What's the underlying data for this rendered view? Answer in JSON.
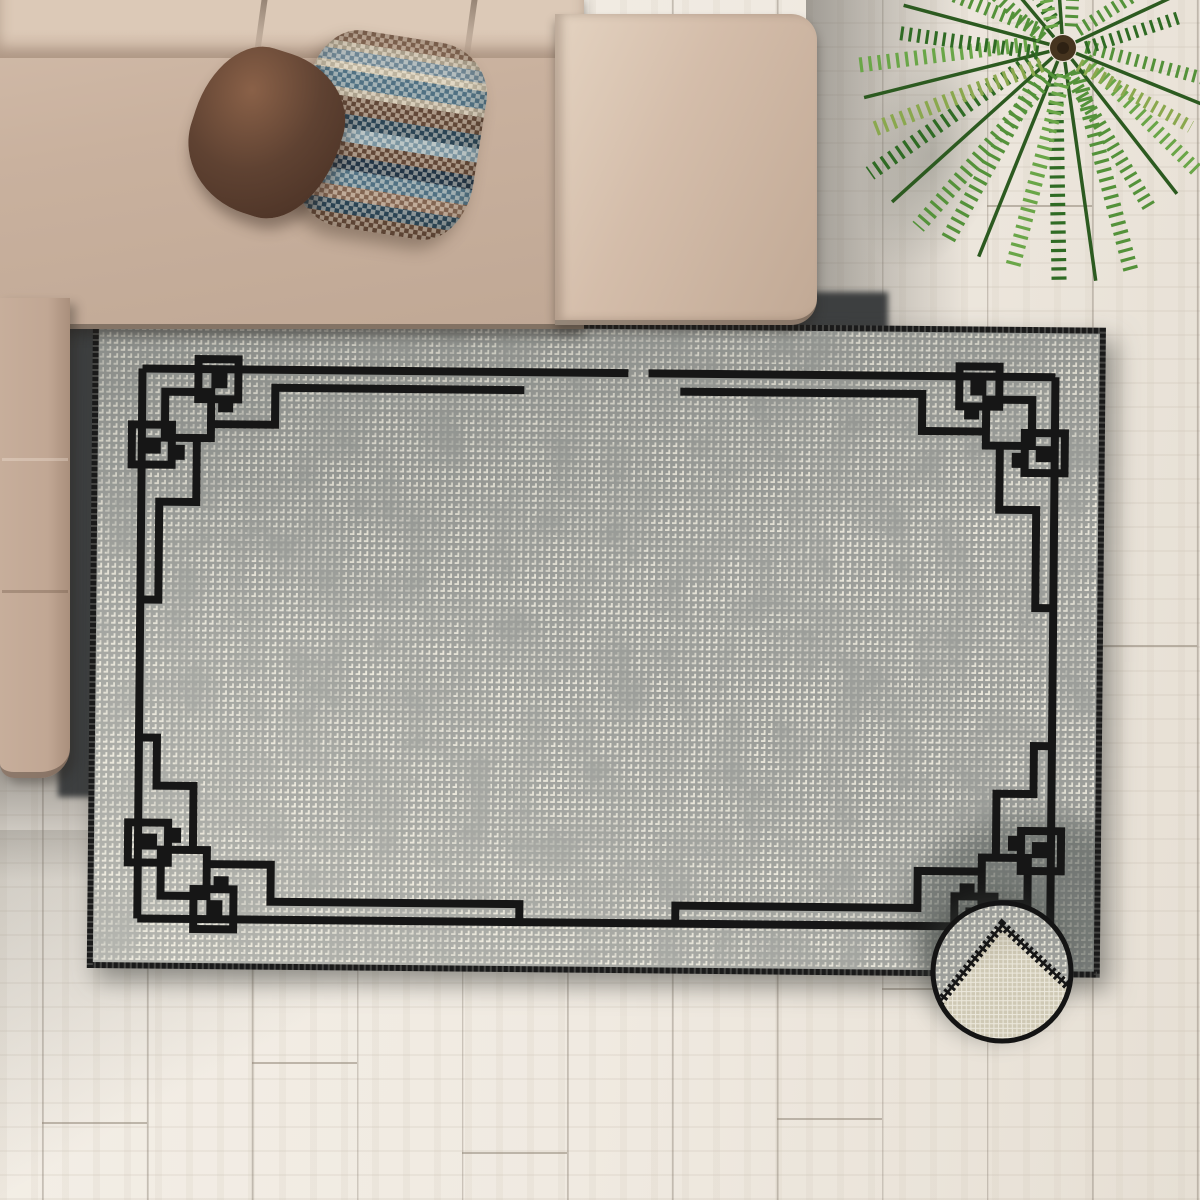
{
  "scene": {
    "type": "product-photo",
    "subject": "gray distressed area rug with black geometric fret border, top-down living-room view",
    "items": [
      "wood-plank-floor",
      "beige-sectional-sofa",
      "brown-velvet-pillow",
      "checkered-stripe-pillow",
      "area-rug",
      "folded-corner-detail-inset",
      "palm-plant"
    ]
  },
  "colors": {
    "floor": "#efe9e0",
    "floorLine": "#8f8274",
    "sofa": "#c9b19e",
    "sofaLight": "#dcc9b7",
    "sofaDark": "#a98f7c",
    "sofaShadow": "#3d3f40",
    "pillowBrown": "#5f4232",
    "pillowBrownLight": "#8a6148",
    "rugGray": "#9c9e9a",
    "rugCream": "#ece9dc",
    "rugLine": "#161616",
    "rugEdge": "#1a1a1a",
    "rugBackCream": "#cfc9b5",
    "insetRing": "#141414",
    "palmDark": "#2f6b24",
    "palmMid": "#54923a",
    "palmLight": "#6aa648",
    "palmYellow": "#8aa84e",
    "palmCenter": "#46341f"
  },
  "pillow_check": {
    "light": "rgba(236,228,214,0.50)",
    "dark": "rgba(25,30,35,0.14)",
    "stripes": [
      {
        "c": "#93715a",
        "from": 0,
        "to": 7
      },
      {
        "c": "#c4b79f",
        "from": 7,
        "to": 11
      },
      {
        "c": "#7e98a8",
        "from": 11,
        "to": 17
      },
      {
        "c": "#d8cdb4",
        "from": 17,
        "to": 21
      },
      {
        "c": "#5a7f93",
        "from": 21,
        "to": 30
      },
      {
        "c": "#c4b79f",
        "from": 30,
        "to": 34
      },
      {
        "c": "#6e4f3b",
        "from": 34,
        "to": 43
      },
      {
        "c": "#2e4a5c",
        "from": 43,
        "to": 50
      },
      {
        "c": "#8aa7b5",
        "from": 50,
        "to": 57
      },
      {
        "c": "#6e4f3b",
        "from": 57,
        "to": 64
      },
      {
        "c": "#24384a",
        "from": 64,
        "to": 71
      },
      {
        "c": "#5a7f93",
        "from": 71,
        "to": 79
      },
      {
        "c": "#93715a",
        "from": 79,
        "to": 86
      },
      {
        "c": "#2e4a5c",
        "from": 86,
        "to": 93
      },
      {
        "c": "#6e4f3b",
        "from": 93,
        "to": 100
      }
    ]
  },
  "inset": {
    "shape": "circle",
    "shows": "rug corner folded back revealing woven backing with serged zigzag edge"
  }
}
